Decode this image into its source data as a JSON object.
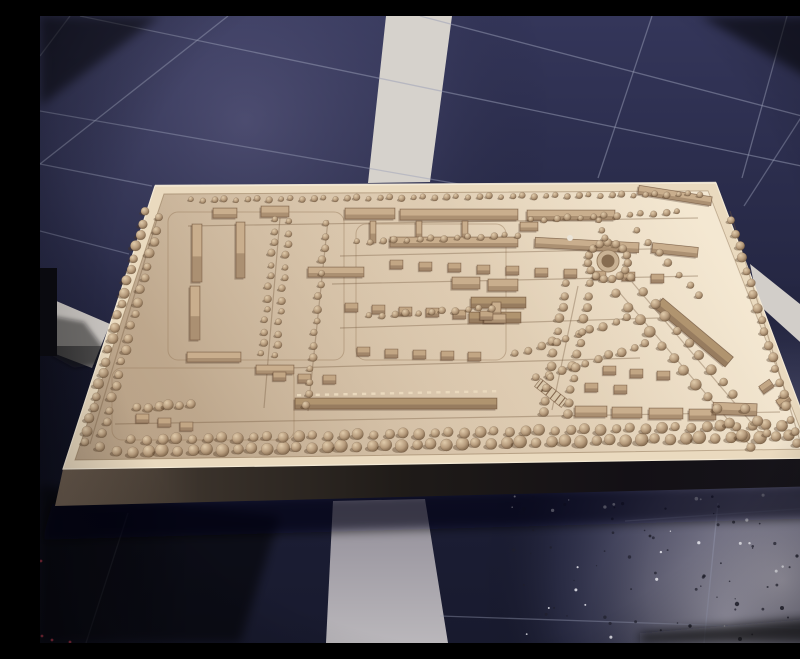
{
  "scene": {
    "subject": "wooden-architectural-town-model-on-blue-tiled-floor",
    "width": 800,
    "height": 627
  },
  "palette": {
    "floor_top": "#34365a",
    "floor_mid": "#262845",
    "floor_low": "#1d1f37",
    "floor_bottom": "#181a2e",
    "lit": "rgba(125,122,162,0.38)",
    "glare_a": "rgba(184,180,194,0.92)",
    "glare_b": "rgba(148,146,170,0.55)",
    "glare_c": "rgba(90,92,125,0.22)",
    "glare2": "rgba(205,202,212,0.38)",
    "grout": "#999eb6",
    "band_white": "#d2cec9",
    "band_left": "#c9c5c1",
    "band_top_col": "#d6d2cc",
    "band_bottom_top": "#908c97",
    "band_bottom_bot": "#bab7bb",
    "strip": "#c8c5ce",
    "wedge": "#d8d5dc",
    "board_hi": "#efe1c9",
    "board_mid": "#ddcab0",
    "board_lo": "#c8b297",
    "rim": "#eadabf",
    "rim_edge": "#f4ead6",
    "groove_line": "rgba(150,122,92,0.45)",
    "surface_stroke": "rgba(150,125,95,0.6)",
    "plinth_1": "#6b5c4e",
    "plinth_2": "#3a322b",
    "plinth_3": "#1f1b18",
    "plinth_4": "#131015",
    "plinth_5": "#17151b",
    "tree_hi": "#e0cbab",
    "tree_mid": "#b69b7c",
    "tree_lo": "#735a40",
    "tree_shadow": "rgba(75,52,32,0.38)",
    "bld": "#ab9072",
    "bld_roof": "#c9ae8d",
    "bld_stroke": "rgba(95,66,43,0.55)",
    "bld_dark": "#977c5f",
    "bld_dark_roof": "#b0946f",
    "house": "#a1866a",
    "house_roof": "#c2a684",
    "dash": "#ead9bd",
    "street": "rgba(118,92,66,0.38)",
    "shadow_soft": "rgba(4,5,12,0.62)",
    "object_black": "#0b0b10",
    "object_shadow": "rgba(15,14,20,0.5)",
    "speck_dark": "#20202c",
    "speck_light": "#e9e9ef",
    "red_speck": "#6e2330",
    "white_ball": "#eae4d8",
    "corner_dark": "rgba(4,4,9,0.55)"
  },
  "floor": {
    "bands": {
      "top_column": [
        [
          346,
          0
        ],
        [
          412,
          0
        ],
        [
          390,
          166
        ],
        [
          328,
          167
        ]
      ],
      "left_row": [
        [
          0,
          278
        ],
        [
          70,
          308
        ],
        [
          52,
          352
        ],
        [
          0,
          332
        ]
      ],
      "right_row": [
        [
          710,
          248
        ],
        [
          800,
          320
        ],
        [
          800,
          362
        ],
        [
          718,
          288
        ]
      ],
      "bottom_column": [
        [
          293,
          485
        ],
        [
          385,
          483
        ],
        [
          408,
          627
        ],
        [
          286,
          627
        ]
      ],
      "right_strip": [
        [
          786,
          358
        ],
        [
          794,
          356
        ],
        [
          798,
          443
        ],
        [
          789,
          444
        ]
      ],
      "corner_wedge": [
        [
          783,
          438
        ],
        [
          800,
          452
        ],
        [
          800,
          472
        ],
        [
          789,
          454
        ]
      ]
    },
    "grout_steep": [
      [
        30,
        0,
        0,
        40,
        0.45
      ],
      [
        188,
        0,
        0,
        148,
        0.5
      ],
      [
        612,
        0,
        558,
        162,
        0.5
      ],
      [
        747,
        0,
        702,
        162,
        0.5
      ],
      [
        762,
        100,
        704,
        190,
        0.45
      ],
      [
        88,
        497,
        46,
        627,
        0.35
      ],
      [
        678,
        487,
        664,
        627,
        0.4
      ]
    ],
    "grout_shallow": [
      [
        380,
        0,
        800,
        110,
        0.5
      ],
      [
        40,
        0,
        800,
        158,
        0.5
      ],
      [
        0,
        95,
        430,
        170,
        0.45
      ],
      [
        0,
        148,
        112,
        170,
        0.45
      ],
      [
        0,
        215,
        89,
        238,
        0.4
      ],
      [
        400,
        600,
        783,
        613,
        0.4
      ],
      [
        585,
        505,
        800,
        490,
        0.35
      ]
    ],
    "speckles": {
      "seed": 11,
      "count": 90,
      "x1": 470,
      "y1": 478,
      "x2": 800,
      "y2": 624,
      "large": [
        [
          697,
          588,
          2.2
        ],
        [
          742,
          592,
          2
        ],
        [
          778,
          575,
          1.8
        ],
        [
          664,
          560,
          1.6
        ],
        [
          700,
          623,
          2
        ],
        [
          757,
          540,
          1.6
        ],
        [
          610,
          520,
          1.4
        ],
        [
          650,
          610,
          1.7
        ]
      ]
    },
    "dark_left_rect": [
      0,
      330,
      150,
      297
    ],
    "bottom_left_dark": [
      [
        0,
        470
      ],
      [
        240,
        500
      ],
      [
        200,
        627
      ],
      [
        0,
        627
      ]
    ],
    "bottom_strip_dark": [
      [
        600,
        617
      ],
      [
        800,
        600
      ],
      [
        800,
        627
      ],
      [
        600,
        627
      ]
    ]
  },
  "artifacts": {
    "black_object": {
      "x": 0,
      "y": 252,
      "w": 17,
      "h": 88
    },
    "black_object_shadow": [
      [
        12,
        300
      ],
      [
        44,
        306
      ],
      [
        74,
        346
      ],
      [
        34,
        352
      ],
      [
        12,
        340
      ]
    ],
    "red_specks": [
      [
        795,
        432
      ],
      [
        795,
        505
      ],
      [
        796,
        520
      ],
      [
        794,
        535
      ],
      [
        795,
        550
      ],
      [
        796,
        563
      ],
      [
        2,
        620
      ],
      [
        12,
        624
      ],
      [
        30,
        626
      ],
      [
        1,
        545
      ]
    ]
  },
  "model": {
    "board_outer": [
      [
        115,
        170
      ],
      [
        676,
        167
      ],
      [
        779,
        442
      ],
      [
        23,
        453
      ]
    ],
    "board_inner": [
      [
        124,
        178
      ],
      [
        668,
        175
      ],
      [
        768,
        433
      ],
      [
        35,
        444
      ]
    ],
    "plinth": [
      [
        23,
        453
      ],
      [
        779,
        442
      ],
      [
        783,
        470
      ],
      [
        15,
        490
      ]
    ],
    "floor_shadow": [
      [
        12,
        488
      ],
      [
        783,
        466
      ],
      [
        796,
        502
      ],
      [
        2,
        524
      ]
    ],
    "grooves": [
      [
        128,
        196,
        176,
        148
      ],
      [
        72,
        352,
        182,
        72
      ],
      [
        316,
        208,
        150,
        136
      ]
    ],
    "streets": [
      [
        240,
        202,
        224,
        392
      ],
      [
        288,
        204,
        268,
        395
      ],
      [
        148,
        210,
        658,
        202
      ],
      [
        300,
        240,
        652,
        232
      ],
      [
        292,
        268,
        658,
        260
      ],
      [
        300,
        312,
        618,
        302
      ],
      [
        248,
        352,
        600,
        342
      ],
      [
        118,
        200,
        50,
        428
      ],
      [
        75,
        408,
        740,
        396
      ],
      [
        690,
        195,
        760,
        425
      ],
      [
        592,
        266,
        726,
        424
      ],
      [
        579,
        276,
        713,
        433
      ],
      [
        538,
        270,
        512,
        394
      ]
    ],
    "bars": [
      [
        173,
        192,
        24,
        10,
        0,
        0
      ],
      [
        221,
        190,
        28,
        11,
        0,
        0
      ],
      [
        305,
        192,
        50,
        11,
        0,
        0
      ],
      [
        360,
        193,
        118,
        11,
        0,
        0
      ],
      [
        487,
        194,
        88,
        10,
        0,
        0
      ],
      [
        598,
        175,
        74,
        9,
        9,
        0
      ],
      [
        152,
        208,
        10,
        58,
        0,
        0
      ],
      [
        150,
        270,
        10,
        54,
        0,
        0
      ],
      [
        196,
        206,
        9,
        56,
        0,
        0
      ],
      [
        330,
        205,
        6,
        22,
        0,
        0
      ],
      [
        376,
        205,
        6,
        22,
        0,
        0
      ],
      [
        422,
        205,
        6,
        22,
        0,
        0
      ],
      [
        350,
        221,
        128,
        10,
        0,
        0
      ],
      [
        495,
        224,
        104,
        10,
        3,
        0
      ],
      [
        612,
        229,
        46,
        10,
        6,
        0
      ],
      [
        412,
        261,
        28,
        12,
        0,
        0
      ],
      [
        448,
        263,
        30,
        12,
        0,
        0
      ],
      [
        268,
        251,
        56,
        10,
        0,
        0
      ],
      [
        431,
        281,
        55,
        11,
        0,
        1
      ],
      [
        429,
        296,
        52,
        11,
        0,
        1
      ],
      [
        147,
        336,
        54,
        10,
        0,
        0
      ],
      [
        216,
        349,
        38,
        9,
        0,
        0
      ],
      [
        608,
        310,
        92,
        13,
        40,
        1
      ],
      [
        255,
        382,
        202,
        11,
        0,
        1
      ],
      [
        535,
        390,
        32,
        11,
        0,
        0
      ],
      [
        572,
        391,
        30,
        11,
        0,
        0
      ],
      [
        609,
        392,
        34,
        11,
        0,
        0
      ],
      [
        649,
        393,
        27,
        11,
        0,
        0
      ],
      [
        673,
        387,
        44,
        12,
        2,
        0
      ],
      [
        452,
        286,
        9,
        17,
        0,
        0
      ],
      [
        444,
        298,
        22,
        9,
        0,
        0
      ],
      [
        480,
        206,
        18,
        9,
        0,
        0
      ]
    ],
    "houses": [
      [
        350,
        244
      ],
      [
        379,
        246
      ],
      [
        408,
        247
      ],
      [
        437,
        249
      ],
      [
        466,
        250
      ],
      [
        495,
        252
      ],
      [
        524,
        253
      ],
      [
        553,
        255
      ],
      [
        582,
        256
      ],
      [
        611,
        258
      ],
      [
        305,
        287
      ],
      [
        332,
        289
      ],
      [
        359,
        291
      ],
      [
        386,
        292
      ],
      [
        413,
        294
      ],
      [
        440,
        295
      ],
      [
        317,
        331
      ],
      [
        345,
        333
      ],
      [
        373,
        334
      ],
      [
        401,
        335
      ],
      [
        428,
        336
      ],
      [
        233,
        356
      ],
      [
        258,
        358
      ],
      [
        283,
        359
      ],
      [
        563,
        350
      ],
      [
        590,
        353
      ],
      [
        617,
        355
      ],
      [
        545,
        367
      ],
      [
        574,
        369
      ],
      [
        96,
        398
      ],
      [
        118,
        402
      ],
      [
        140,
        406
      ],
      [
        720,
        366,
        -35
      ],
      [
        737,
        380,
        -35
      ]
    ],
    "tree_rows": [
      [
        152,
        184,
        660,
        178,
        47,
        3.2
      ],
      [
        106,
        196,
        44,
        426,
        21,
        5.0
      ],
      [
        120,
        202,
        60,
        430,
        20,
        4.6
      ],
      [
        78,
        436,
        750,
        420,
        46,
        6.2
      ],
      [
        92,
        424,
        742,
        409,
        44,
        5.4
      ],
      [
        692,
        205,
        758,
        428,
        19,
        4.6
      ],
      [
        592,
        262,
        728,
        418,
        13,
        5.0
      ],
      [
        577,
        278,
        712,
        432,
        13,
        5.4
      ],
      [
        236,
        204,
        222,
        338,
        13,
        3.6
      ],
      [
        250,
        206,
        236,
        340,
        13,
        3.6
      ],
      [
        287,
        208,
        267,
        390,
        16,
        3.8
      ],
      [
        318,
        226,
        478,
        219,
        14,
        3.4
      ],
      [
        492,
        204,
        638,
        196,
        13,
        3.4
      ],
      [
        476,
        338,
        588,
        302,
        10,
        4.2
      ],
      [
        497,
        362,
        606,
        328,
        10,
        4.4
      ],
      [
        330,
        300,
        452,
        292,
        11,
        3.6
      ],
      [
        98,
        392,
        150,
        388,
        6,
        5.0
      ],
      [
        527,
        268,
        503,
        396,
        12,
        4.4
      ],
      [
        551,
        268,
        527,
        398,
        12,
        4.4
      ],
      [
        560,
        205,
        564,
        222,
        3,
        3.4
      ],
      [
        598,
        215,
        660,
        280,
        7,
        3.8
      ]
    ],
    "roundabout": {
      "cx": 568,
      "cy": 245,
      "ring_r": 20,
      "n": 15,
      "tree_r": 4,
      "disc_r": 11,
      "hole_r": 6.5,
      "disc_fill": "#c9b294",
      "disc_stroke": "#9a8164",
      "hole_fill": "#866c50"
    },
    "ladder": {
      "x": 511,
      "y": 377,
      "rot": 38,
      "len": 34,
      "wid": 10,
      "rungs": 6
    },
    "dashes": {
      "x1": 257,
      "y1": 378,
      "x2": 452,
      "y2": 374,
      "n": 22
    },
    "white_ball": {
      "x": 530,
      "y": 222,
      "r": 3
    }
  }
}
